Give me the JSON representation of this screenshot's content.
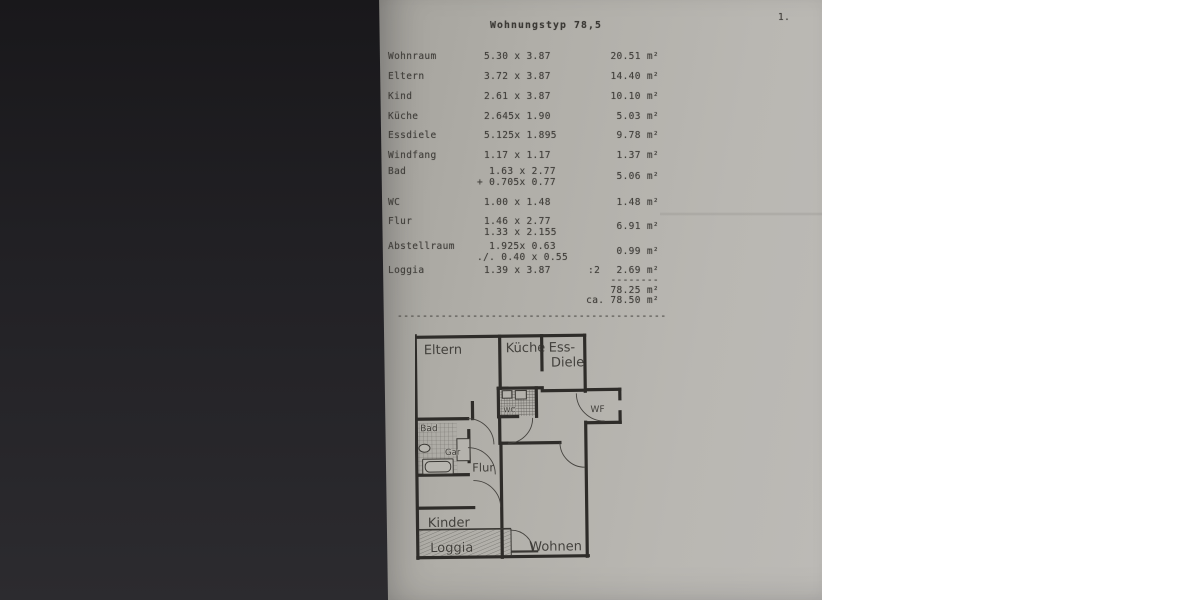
{
  "page": {
    "number_label": "1."
  },
  "document": {
    "title": "Wohnungstyp 78,5",
    "rows": [
      {
        "name": "Wohnraum",
        "dim1": "5.30 x 3.87",
        "area": "20.51 m²"
      },
      {
        "name": "Eltern",
        "dim1": "3.72 x 3.87",
        "area": "14.40 m²"
      },
      {
        "name": "Kind",
        "dim1": "2.61 x 3.87",
        "area": "10.10 m²"
      },
      {
        "name": "Küche",
        "dim1": "2.645x 1.90",
        "area": "5.03 m²"
      },
      {
        "name": "Essdiele",
        "dim1": "5.125x 1.895",
        "area": "9.78 m²"
      },
      {
        "name": "Windfang",
        "dim1": "1.17 x 1.17",
        "area": "1.37 m²"
      },
      {
        "name": "Bad",
        "dim1": "  1.63 x 2.77",
        "dim2": "+ 0.705x 0.77",
        "area": "5.06 m²"
      },
      {
        "name": "WC",
        "dim1": "1.00 x 1.48",
        "area": "1.48 m²"
      },
      {
        "name": "Flur",
        "dim1": "1.46 x 2.77",
        "dim2": "1.33 x 2.155",
        "area": "6.91 m²"
      },
      {
        "name": "Abstellraum",
        "dim1": "  1.925x 0.63",
        "dim2": "./. 0.40 x 0.55",
        "area": "0.99 m²"
      },
      {
        "name": "Loggia",
        "dim1": "1.39 x 3.87",
        "divisor": ":2",
        "area": "2.69 m²"
      }
    ],
    "totals": {
      "dashes": "--------",
      "subtotal": "78.25 m²",
      "approx": "ca. 78.50 m²"
    },
    "separator": "-------------------------------------------"
  },
  "floorplan": {
    "labels": {
      "eltern": "Eltern",
      "kueche": "Küche",
      "ess": "Ess-",
      "diele": "Diele",
      "wc": "WC",
      "wf": "WF",
      "bad": "Bad",
      "gar": "Gar",
      "flur": "Flur",
      "kinder": "Kinder",
      "loggia": "Loggia",
      "wohnen": "Wohnen"
    }
  }
}
